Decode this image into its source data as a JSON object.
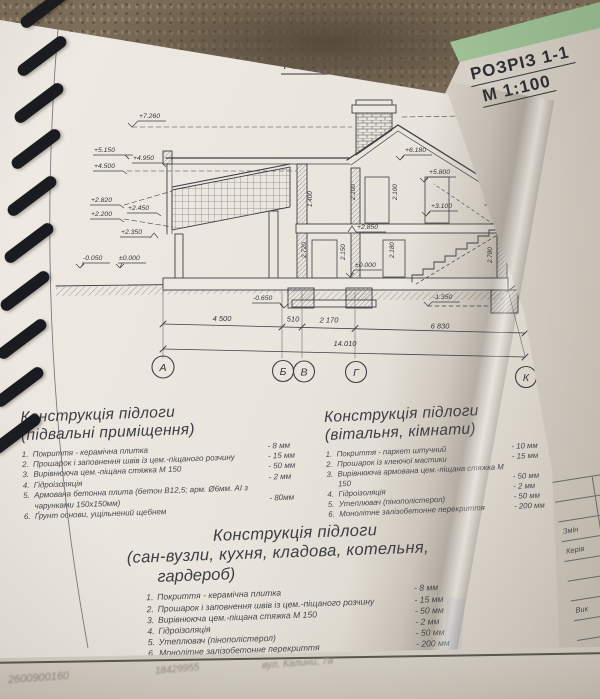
{
  "corner_tab": {
    "line1": "РОЗРІЗ 1-1",
    "line2": "М 1:100"
  },
  "drawing": {
    "title": "РОЗРІЗ 1-1",
    "marks_left": [
      "+7.260",
      "+5.150",
      "+4.950",
      "+4.500",
      "+2.820",
      "+2.450",
      "+2.200",
      "+2.350",
      "-0.050",
      "±0.000"
    ],
    "marks_right": [
      "8.080",
      "+5.950",
      "+5.260",
      "+4.370",
      "+4.160",
      "+2.760",
      "±0.000",
      "1.000",
      "300"
    ],
    "marks_mid": [
      "+6.180",
      "+5.800",
      "+3.100",
      "+2.850",
      "±0.000",
      "-0.650",
      "-1.350"
    ],
    "dims": [
      "4 500",
      "510",
      "2 170",
      "6 830",
      "14.010"
    ],
    "axes": [
      "А",
      "Б",
      "В",
      "Г",
      "К"
    ],
    "vdims": [
      "2.100",
      "2.100",
      "1.400",
      "2.720",
      "2.150",
      "2.180",
      "1.400",
      "2.780"
    ]
  },
  "specs": [
    {
      "title": "Конструкція підлоги",
      "subtitle": "(підвальні приміщення)",
      "subtitle2": "",
      "items": [
        {
          "n": "1.",
          "text": "Покриття - керамічна плитка",
          "value": "- 8 мм"
        },
        {
          "n": "2.",
          "text": "Прошарок і заповнення швів із цем.-піщаного розчину",
          "value": "- 15 мм"
        },
        {
          "n": "3.",
          "text": "Вирівнююча цем.-піщана стяжка  М 150",
          "value": "- 50 мм"
        },
        {
          "n": "4.",
          "text": "Гідроізоляція",
          "value": "- 2 мм"
        },
        {
          "n": "5.",
          "text": "Армована бетонна плита  (бетон В12,5; арм. Ø6мм. АІ з чарунками 150х150мм)",
          "value": "- 80мм"
        },
        {
          "n": "6.",
          "text": "Ґрунт основи, ущільнений щебнем",
          "value": ""
        }
      ]
    },
    {
      "title": "Конструкція підлоги",
      "subtitle": "(вітальня, кімнати)",
      "subtitle2": "",
      "items": [
        {
          "n": "1.",
          "text": "Покриття - паркет штучний",
          "value": "- 10 мм"
        },
        {
          "n": "2.",
          "text": "Прошарок із клеючої мастики",
          "value": "- 15 мм"
        },
        {
          "n": "3.",
          "text": "Вирівнююча армована цем.-піщана стяжка  М 150",
          "value": "- 50 мм"
        },
        {
          "n": "4.",
          "text": "Гідроізоляція",
          "value": "- 2 мм"
        },
        {
          "n": "5.",
          "text": "Утеплювач (пінополістерол)",
          "value": "- 50 мм"
        },
        {
          "n": "6.",
          "text": "Монолітне залізобетонне перекриття",
          "value": "- 200 мм"
        }
      ]
    },
    {
      "title": "Конструкція підлоги",
      "subtitle": "(сан-вузли, кухня, кладова, котельня,",
      "subtitle2": "гардероб)",
      "items": [
        {
          "n": "1.",
          "text": "Покриття - керамічна плитка",
          "value": "- 8 мм"
        },
        {
          "n": "2.",
          "text": "Прошарок і заповнення швів із цем.-піщаного розчину",
          "value": "- 15 мм"
        },
        {
          "n": "3.",
          "text": "Вирівнююча цем.-піщана стяжка  М 150",
          "value": "- 50 мм"
        },
        {
          "n": "4.",
          "text": "Гідроізоляція",
          "value": "- 2 мм"
        },
        {
          "n": "5.",
          "text": "Утеплювач (пінополістерол)",
          "value": "- 50 мм"
        },
        {
          "n": "6.",
          "text": "Монолітне залізобетонне перекриття",
          "value": "- 200 мм"
        }
      ]
    }
  ],
  "title_block": {
    "rows": [
      "",
      "",
      "Змін",
      "Керів",
      "",
      "",
      "Вик",
      ""
    ]
  },
  "under_sheet": {
    "text1": "2600900160",
    "text2": "18429955",
    "text3": "вул. Калини, 7а"
  }
}
